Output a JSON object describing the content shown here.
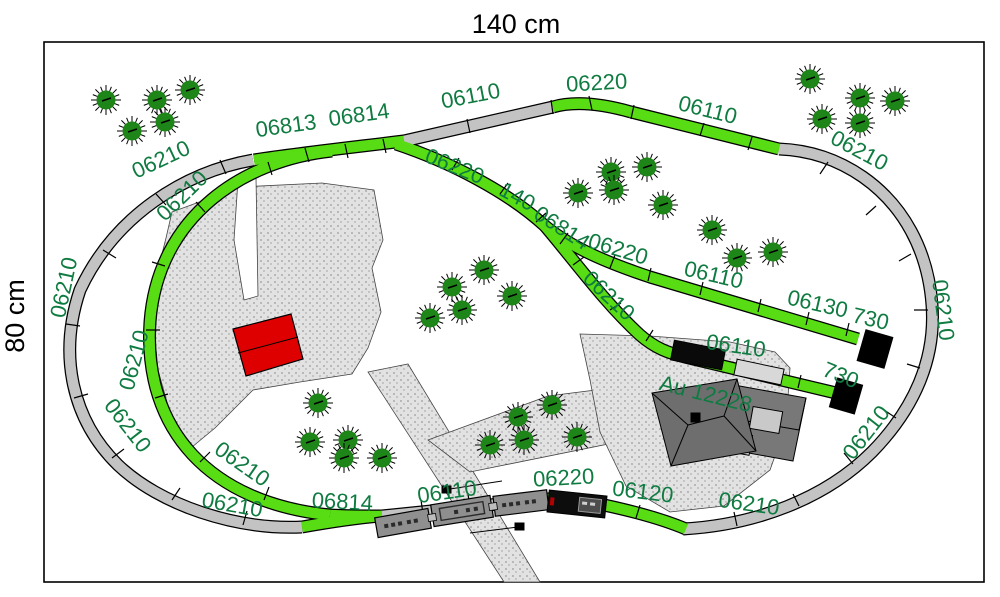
{
  "dimensions": {
    "width_label": "140 cm",
    "height_label": "80 cm"
  },
  "colors": {
    "track_green": "#58dc13",
    "track_gray": "#c3c3c3",
    "label_green": "#0f7b41",
    "tree_green": "#1e8519",
    "red_house": "#de0000",
    "farm_roof_dark": "#6e6e6e",
    "farm_roof_mid": "#787878",
    "annex_gray": "#c9c9c9",
    "gravel_gray": "#e2e2e2",
    "buffer_black": "#000000",
    "coach_gray": "#8f8f8f",
    "loco_black": "#0d0d0d"
  },
  "labels": [
    {
      "text": "06210",
      "x": 164,
      "y": 166,
      "rot": -25
    },
    {
      "text": "06210",
      "x": 187,
      "y": 201,
      "rot": -44
    },
    {
      "text": "06813",
      "x": 287,
      "y": 133,
      "rot": -8
    },
    {
      "text": "06814",
      "x": 360,
      "y": 122,
      "rot": -8
    },
    {
      "text": "06110",
      "x": 472,
      "y": 103,
      "rot": -11
    },
    {
      "text": "06220",
      "x": 597,
      "y": 90,
      "rot": -3
    },
    {
      "text": "06110",
      "x": 706,
      "y": 117,
      "rot": 14
    },
    {
      "text": "06210",
      "x": 856,
      "y": 157,
      "rot": 28
    },
    {
      "text": "06220",
      "x": 452,
      "y": 173,
      "rot": 22
    },
    {
      "text": "140",
      "x": 514,
      "y": 203,
      "rot": 28
    },
    {
      "text": "06814",
      "x": 558,
      "y": 234,
      "rot": 33
    },
    {
      "text": "06220",
      "x": 616,
      "y": 256,
      "rot": 17
    },
    {
      "text": "06110",
      "x": 712,
      "y": 282,
      "rot": 13
    },
    {
      "text": "06130",
      "x": 816,
      "y": 311,
      "rot": 13
    },
    {
      "text": "730",
      "x": 869,
      "y": 326,
      "rot": 13
    },
    {
      "text": "06210",
      "x": 604,
      "y": 301,
      "rot": 43
    },
    {
      "text": "06110",
      "x": 735,
      "y": 353,
      "rot": 8
    },
    {
      "text": "730",
      "x": 838,
      "y": 382,
      "rot": 22
    },
    {
      "text": "06210",
      "x": 936,
      "y": 311,
      "rot": 83
    },
    {
      "text": "06210",
      "x": 872,
      "y": 437,
      "rot": -52
    },
    {
      "text": "06210",
      "x": 748,
      "y": 511,
      "rot": 8
    },
    {
      "text": "06120",
      "x": 642,
      "y": 499,
      "rot": 7
    },
    {
      "text": "06220",
      "x": 564,
      "y": 485,
      "rot": -3
    },
    {
      "text": "06110",
      "x": 448,
      "y": 499,
      "rot": -8
    },
    {
      "text": "06814",
      "x": 342,
      "y": 509,
      "rot": 3
    },
    {
      "text": "06210",
      "x": 231,
      "y": 512,
      "rot": 10
    },
    {
      "text": "06210",
      "x": 238,
      "y": 470,
      "rot": 35
    },
    {
      "text": "06210",
      "x": 122,
      "y": 430,
      "rot": 52
    },
    {
      "text": "06210",
      "x": 141,
      "y": 362,
      "rot": -75
    },
    {
      "text": "06210",
      "x": 71,
      "y": 289,
      "rot": -78
    }
  ],
  "farm_label": {
    "text": "Au 12228",
    "x": 704,
    "y": 401,
    "rot": 14
  },
  "trees": [
    [
      106,
      100
    ],
    [
      157,
      100
    ],
    [
      190,
      90
    ],
    [
      132,
      131
    ],
    [
      165,
      122
    ],
    [
      810,
      79
    ],
    [
      860,
      98
    ],
    [
      895,
      101
    ],
    [
      822,
      119
    ],
    [
      860,
      123
    ],
    [
      611,
      172
    ],
    [
      647,
      167
    ],
    [
      578,
      193
    ],
    [
      614,
      190
    ],
    [
      663,
      205
    ],
    [
      712,
      230
    ],
    [
      737,
      258
    ],
    [
      773,
      252
    ],
    [
      484,
      270
    ],
    [
      452,
      287
    ],
    [
      512,
      296
    ],
    [
      462,
      310
    ],
    [
      430,
      318
    ],
    [
      318,
      403
    ],
    [
      310,
      442
    ],
    [
      348,
      440
    ],
    [
      344,
      458
    ],
    [
      382,
      458
    ],
    [
      518,
      417
    ],
    [
      552,
      405
    ],
    [
      490,
      445
    ],
    [
      524,
      440
    ],
    [
      577,
      437
    ]
  ],
  "train": {
    "coach_count": 3,
    "locomotive_count": 1
  },
  "buffer_stop_count": 2
}
